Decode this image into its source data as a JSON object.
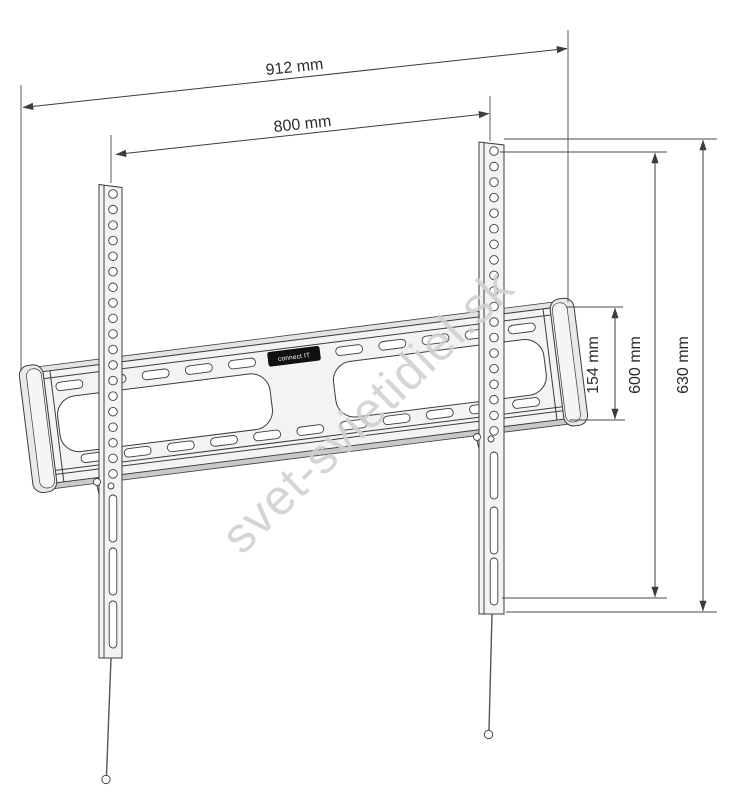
{
  "drawing": {
    "subject": "fixed TV wall mount bracket - dimensional line drawing",
    "dimensions": {
      "overall_width": "912 mm",
      "mount_width": "800 mm",
      "plate_height": "154 mm",
      "mount_height": "600 mm",
      "overall_height": "630 mm"
    },
    "badge": {
      "brand": "connect IT"
    },
    "watermark": {
      "text": "svet-svietidiel.sk"
    },
    "colors": {
      "line": "#3c3c3c",
      "metal_light": "#f3f3f3",
      "metal_mid": "#e4e4e4",
      "metal_dark": "#c9c9c9",
      "badge_bg": "#111111",
      "badge_text": "#ffffff",
      "watermark": "#d0d0d0"
    }
  }
}
